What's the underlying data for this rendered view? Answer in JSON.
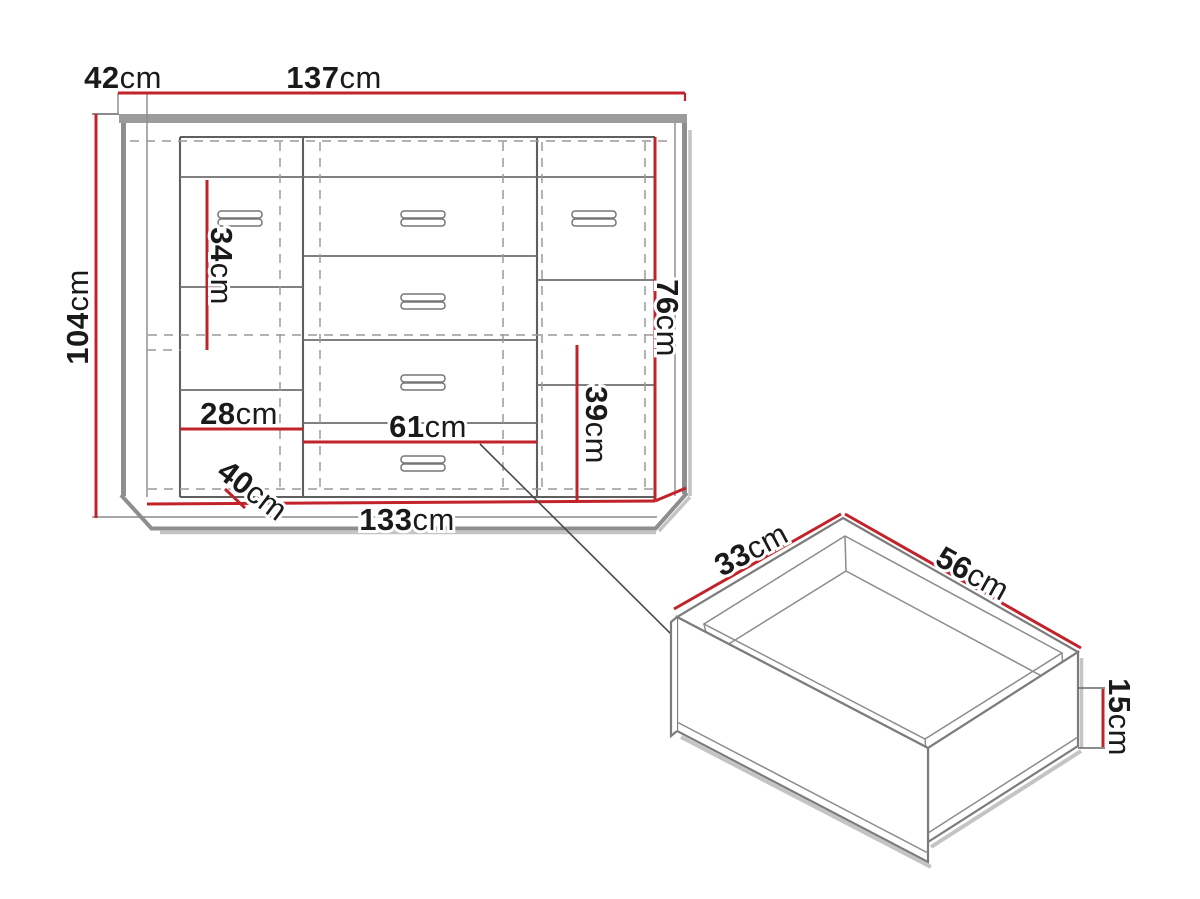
{
  "figure": {
    "type": "furniture-dimension-diagram",
    "unit": "cm",
    "colors": {
      "dimension_red": "#c2232a",
      "outline_gray": "#8e8e8e",
      "text_black": "#1a1a1a"
    },
    "cabinet": {
      "view": "sideboard-front-view",
      "dims": {
        "depth_top": {
          "num": "42",
          "unit": "cm"
        },
        "width_overall": {
          "num": "137",
          "unit": "cm"
        },
        "height_overall": {
          "num": "104",
          "unit": "cm"
        },
        "left_shelf_height": {
          "num": "34",
          "unit": "cm"
        },
        "left_section_width": {
          "num": "28",
          "unit": "cm"
        },
        "base_depth": {
          "num": "40",
          "unit": "cm"
        },
        "center_section_width": {
          "num": "61",
          "unit": "cm"
        },
        "right_shelf_height": {
          "num": "39",
          "unit": "cm"
        },
        "right_door_height": {
          "num": "76",
          "unit": "cm"
        },
        "width_base": {
          "num": "133",
          "unit": "cm"
        }
      }
    },
    "drawer": {
      "view": "drawer-isometric-view",
      "dims": {
        "depth": {
          "num": "33",
          "unit": "cm"
        },
        "width": {
          "num": "56",
          "unit": "cm"
        },
        "height": {
          "num": "15",
          "unit": "cm"
        }
      }
    }
  }
}
